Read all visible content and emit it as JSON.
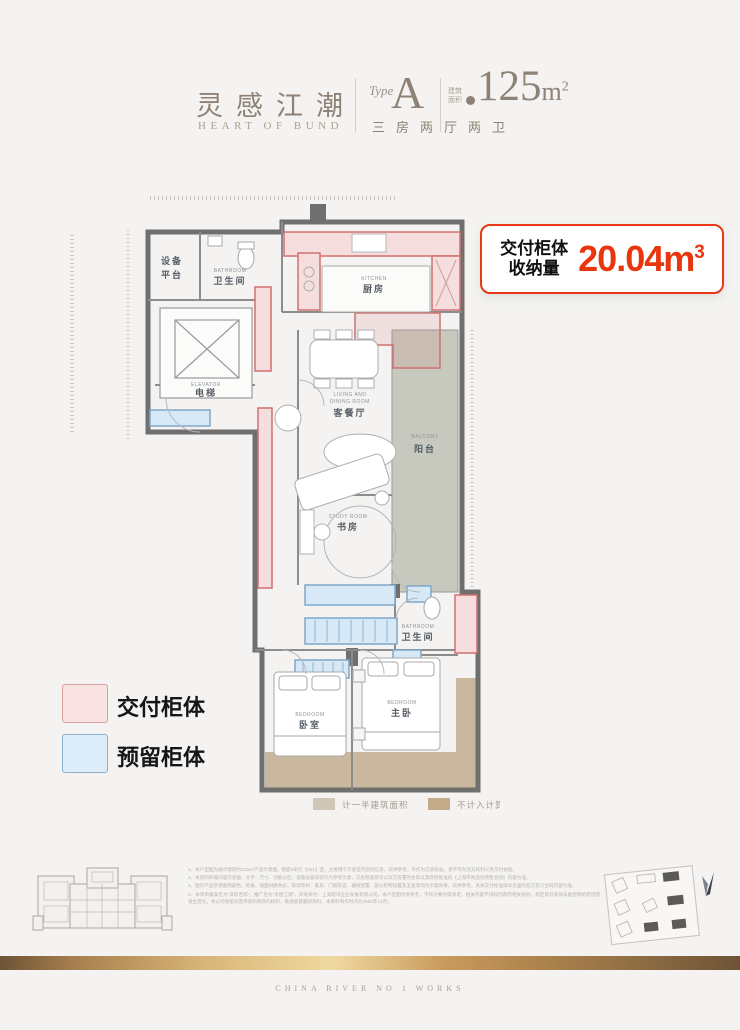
{
  "header": {
    "logo_cn": "灵感江潮",
    "logo_en": "HEART OF BUND",
    "type_label": "Type",
    "type_value": "A",
    "area_prefix": "建筑面积",
    "area_value": "125",
    "area_unit": "m",
    "area_unit_exp": "2",
    "layout": "三房两厅两卫"
  },
  "badge": {
    "label_line1": "交付柜体",
    "label_line2": "收纳量",
    "value": "20.04",
    "unit": "m",
    "unit_exp": "3",
    "accent_color": "#e8360e"
  },
  "legend": {
    "delivered": {
      "label": "交付柜体",
      "fill": "#f9e2e2",
      "border": "#d9a0a0"
    },
    "reserved": {
      "label": "预留柜体",
      "fill": "#dcedf9",
      "border": "#8ab0cd"
    }
  },
  "plan": {
    "rooms": {
      "equipment_1": "设备",
      "equipment_2": "平台",
      "bath1_en": "BATHROOM",
      "bath1_cn": "卫生间",
      "elevator_en": "ELEVATOR",
      "elevator_cn": "电梯",
      "kitchen_en": "KITCHEN",
      "kitchen_cn": "厨房",
      "living_en1": "LIVING AND",
      "living_en2": "DINING ROOM",
      "living_cn": "客餐厅",
      "balcony_en": "BALCONY",
      "balcony_cn": "阳台",
      "study_en": "STUDY ROOM",
      "study_cn": "书房",
      "bath2_en": "BATHROOM",
      "bath2_cn": "卫生间",
      "bed1_en": "BEDROOM",
      "bed1_cn": "卧室",
      "bed2_en": "BEDROOM",
      "bed2_cn": "主卧"
    },
    "area_legend": {
      "half": {
        "label": "计一半建筑面积",
        "color": "#cfc8b8"
      },
      "excluded": {
        "label": "不计入计算面积",
        "color": "#c3ab8a"
      }
    },
    "colors": {
      "cabinet_red_fill": "#f7dede",
      "cabinet_red_border": "#d07070",
      "cabinet_blue_fill": "#d7e9f7",
      "cabinet_blue_border": "#7fa7c9",
      "balcony": "#c7c9bf",
      "tan": "#c9b89e",
      "wall": "#6f6f6f"
    }
  },
  "notes": {
    "line1": "1、本户型图为展示建筑约125m²产品示意图，鹤庭8单元【601】室，主要用于示意室内空间信息，仅供参考，不作为交房标准，更不作为双方权利义务交付依据。",
    "line2": "2、本资料所载内容示意图、文字、尺寸、功能分区、设施设备等仅作为参考示意，交房标准等均以双方签署的合同以及政府批准的《上海市商品房预售合同》内容为准。",
    "line3": "3、图示产品享受图例颜色、地板、墙面材质色彩、软装饰材、家具、门窗形态、器材配置、部分织物设置及五金等均为示意效果，仅供参考，具体交付标准请详见届时双方签订合同内容为准。",
    "line4": "4、本项目备案名为“滨琅名邸”，推广名为“灵感江潮”，开发商为：上海新湾企业发展有限公司。本户型图仅供参考，不作为要约或承诺，相关内容不排除因政府相关规划、规定及开发商未能控制的原因而发生变化，本公司保留对宣传资料修改的权利，敬请留意最新资料。本资料制作时间为2025年10月。"
  },
  "footer": {
    "brand": "CHINA RIVER NO 1 WORKS"
  }
}
